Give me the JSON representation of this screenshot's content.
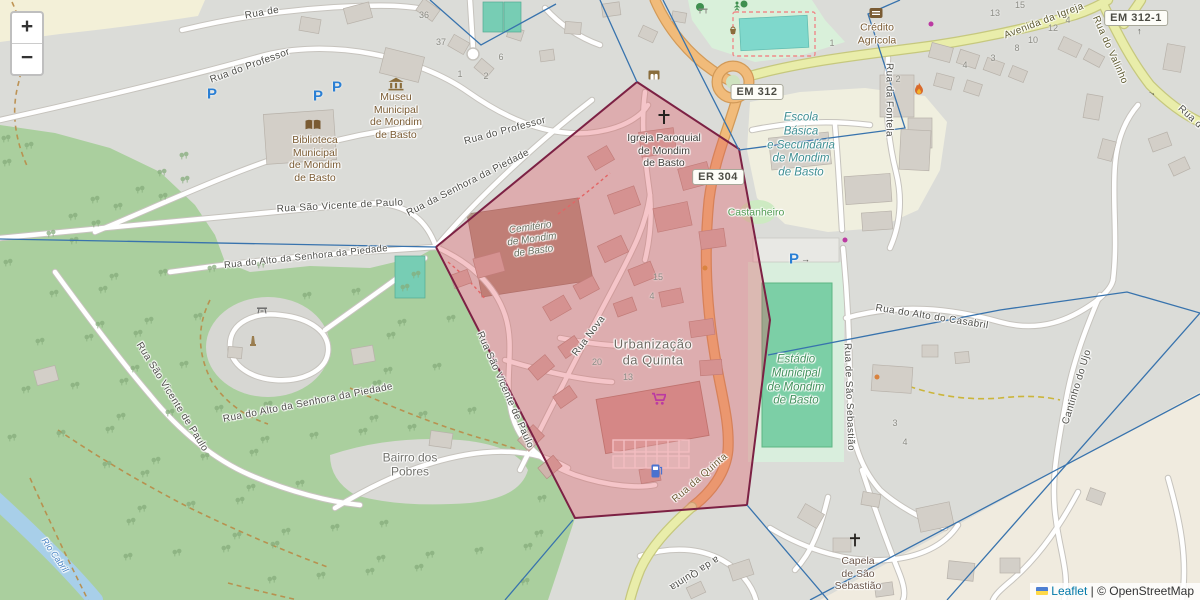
{
  "controls": {
    "zoom_in": "+",
    "zoom_out": "−"
  },
  "attribution": {
    "leaflet": "Leaflet",
    "separator": "|",
    "copyright": "© OpenStreetMap"
  },
  "shields": {
    "em312": "EM 312",
    "er304": "ER 304",
    "em312_1": "EM 312-1"
  },
  "pois": {
    "igreja": "Igreja Paroquial\nde Mondim\nde Basto",
    "museu": "Museu\nMunicipal\nde Mondim\nde Basto",
    "biblioteca": "Biblioteca\nMunicipal\nde Mondim\nde Basto",
    "credito": "Crédito\nAgrícola",
    "escola": "Escola\nBásica\ne Secundária\nde Mondim\nde Basto",
    "estadio": "Estádio\nMunicipal\nde Mondim\nde Basto",
    "cemiterio": "Cemitério\nde Mondim\nde Basto",
    "capela": "Capela\nde São\nSebastião",
    "castanheiro": "Castanheiro",
    "urbanizacao": "Urbanização\nda Quinta",
    "bairro": "Bairro dos\nPobres",
    "parking": "P"
  },
  "streets": {
    "professor": "Rua do Professor",
    "rua_de": "Rua de",
    "sao_vicente": "Rua São Vicente de Paulo",
    "senhora_piedade": "Rua da Senhora da Piedade",
    "alto_senhora": "Rua do Alto da Senhora da Piedade",
    "nova": "Rua Nova",
    "quinta": "Rua da Quinta",
    "quinta_frag": "a da Quinta",
    "fontela": "Rua da Fontela",
    "avenida_igreja": "Avenida da Igreja",
    "valinho": "Rua do Valinho",
    "casabril": "Rua do Alto do Casabril",
    "sao_sebastiao": "Rua de São Sebastião",
    "cantinho_ujo": "Cantinho do Ujo",
    "rua_d_frag": "Rua d",
    "rio": "Rio Cabril"
  },
  "housenumbers": [
    "36",
    "37",
    "6",
    "1",
    "2",
    "15",
    "13",
    "4",
    "12",
    "10",
    "8",
    "3",
    "4",
    "1",
    "2",
    "15",
    "4",
    "20",
    "13",
    "3",
    "4"
  ],
  "arrows": {
    "up": "↑",
    "right": "→"
  }
}
